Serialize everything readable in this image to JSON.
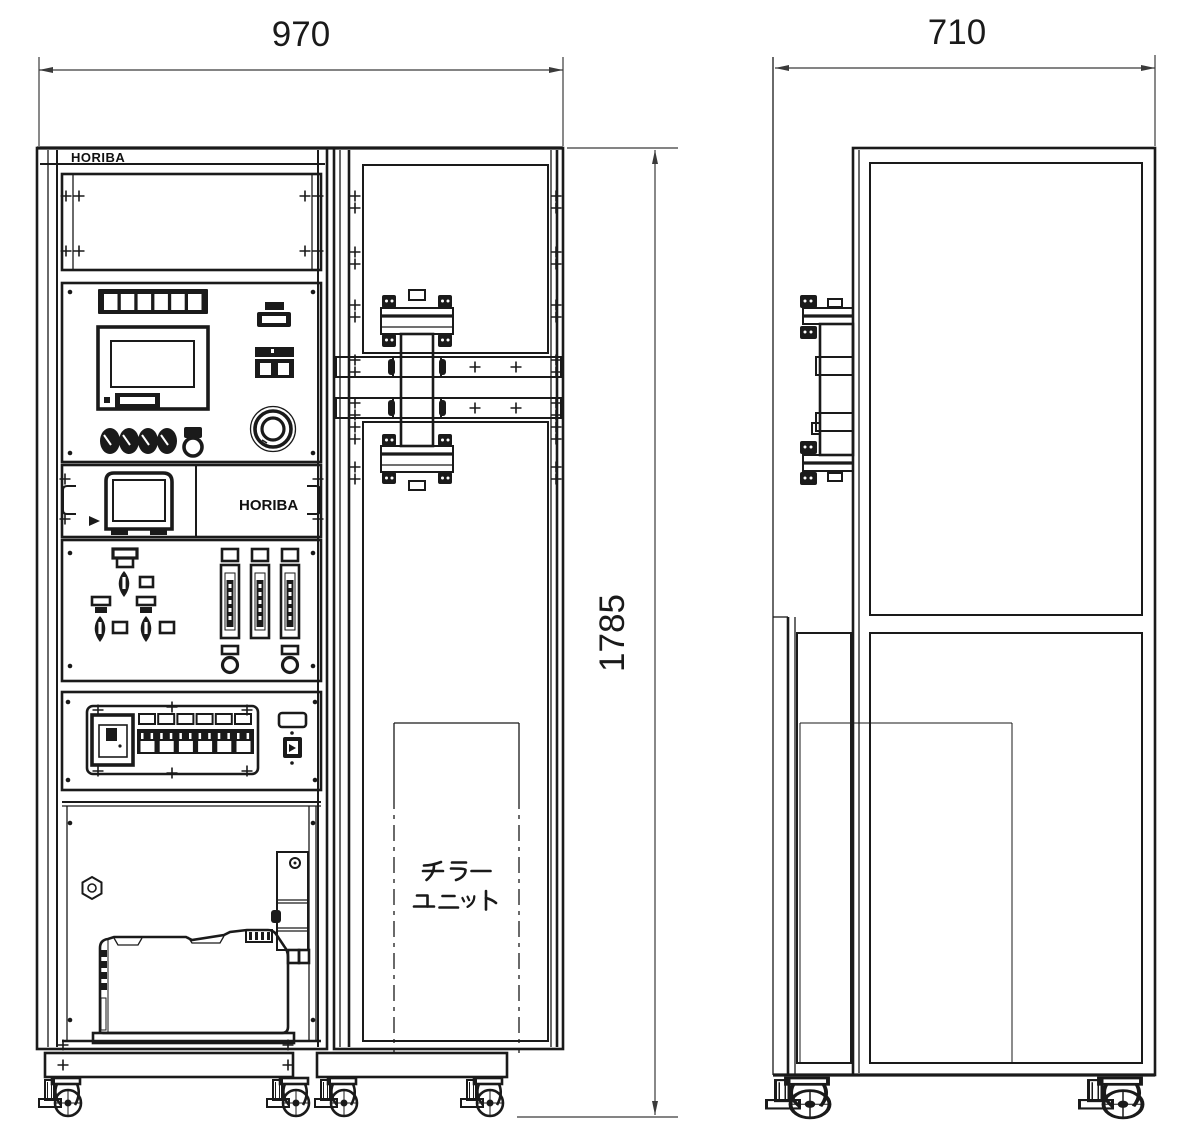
{
  "drawing": {
    "type": "equipment outline drawing, front and side views",
    "background": "#ffffff",
    "line_color": "#1a1a1a"
  },
  "dimensions": {
    "width_front": "970",
    "depth_side": "710",
    "height": "1785"
  },
  "labels": {
    "brand_top": "HORIBA",
    "brand_analyzer": "HORIBA",
    "chiller_unit": "チラーユニット",
    "chiller_line1": "チラー",
    "chiller_line2": "ユニット"
  }
}
